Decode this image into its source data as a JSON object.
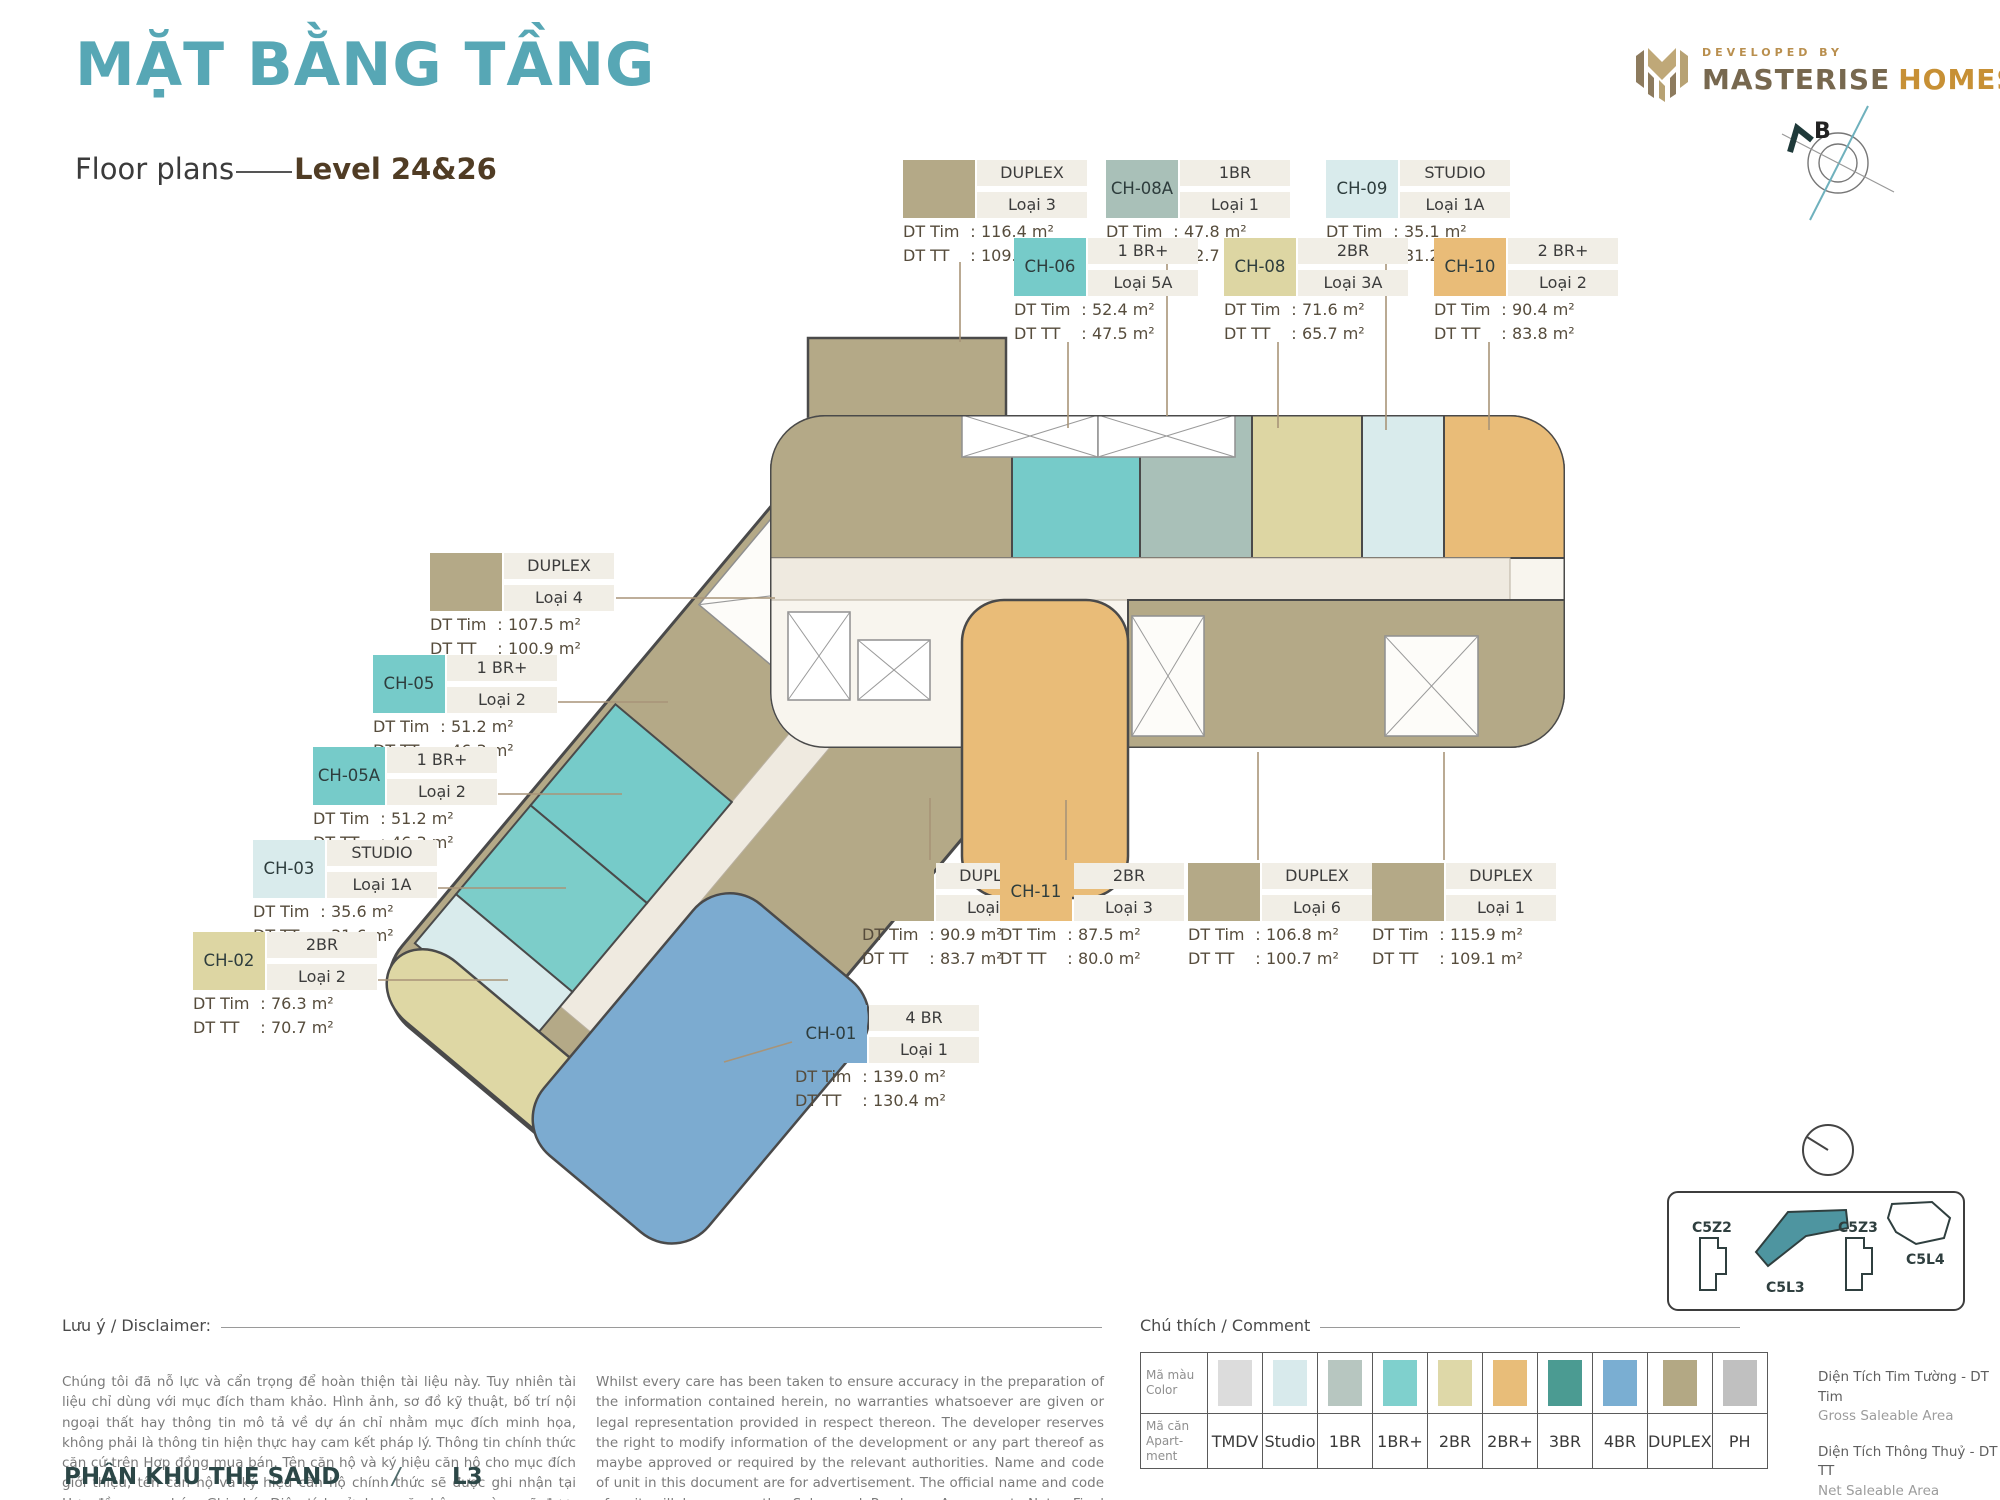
{
  "header": {
    "title": "MẶT BẰNG TẦNG",
    "subtitle": "Floor plans",
    "level": "Level 24&26",
    "developed_by": "DEVELOPED BY",
    "brand_1": "MASTERISE",
    "brand_2": "HOMES",
    "compass_north": "B"
  },
  "labels": {
    "dt_tim": "DT Tim",
    "dt_tt": "DT TT"
  },
  "units": [
    {
      "type": "DUPLEX",
      "loai": "Loại 3",
      "tim": "116.4 m²",
      "tt": "109.8 m²",
      "color": "#b4a987"
    },
    {
      "code": "CH-08A",
      "type": "1BR",
      "loai": "Loại 1",
      "tim": "47.8 m²",
      "tt": "42.7 m²",
      "color": "#a9c0b8"
    },
    {
      "code": "CH-09",
      "type": "STUDIO",
      "loai": "Loại 1A",
      "tim": "35.1 m²",
      "tt": "31.2 m²",
      "color": "#d9ebec"
    },
    {
      "code": "CH-06",
      "type": "1 BR+",
      "loai": "Loại 5A",
      "tim": "52.4 m²",
      "tt": "47.5 m²",
      "color": "#76cbc9"
    },
    {
      "code": "CH-08",
      "type": "2BR",
      "loai": "Loại 3A",
      "tim": "71.6 m²",
      "tt": "65.7 m²",
      "color": "#ddd6a3"
    },
    {
      "code": "CH-10",
      "type": "2 BR+",
      "loai": "Loại 2",
      "tim": "90.4 m²",
      "tt": "83.8 m²",
      "color": "#e9bc78"
    },
    {
      "type": "DUPLEX",
      "loai": "Loại 4",
      "tim": "107.5 m²",
      "tt": "100.9 m²",
      "color": "#b4a987"
    },
    {
      "code": "CH-05",
      "type": "1 BR+",
      "loai": "Loại 2",
      "tim": "51.2 m²",
      "tt": "46.3 m²",
      "color": "#76cbc9"
    },
    {
      "code": "CH-05A",
      "type": "1 BR+",
      "loai": "Loại 2",
      "tim": "51.2 m²",
      "tt": "46.3 m²",
      "color": "#76cbc9"
    },
    {
      "code": "CH-03",
      "type": "STUDIO",
      "loai": "Loại 1A",
      "tim": "35.6 m²",
      "tt": "31.6 m²",
      "color": "#d9ebec"
    },
    {
      "code": "CH-02",
      "type": "2BR",
      "loai": "Loại 2",
      "tim": "76.3 m²",
      "tt": "70.7 m²",
      "color": "#ddd6a3"
    },
    {
      "type": "DUPLEX",
      "loai": "Loại 5",
      "tim": "90.9 m²",
      "tt": "83.7 m²",
      "color": "#b4a987"
    },
    {
      "code": "CH-11",
      "type": "2BR",
      "loai": "Loại 3",
      "tim": "87.5 m²",
      "tt": "80.0 m²",
      "color": "#e9bc78"
    },
    {
      "type": "DUPLEX",
      "loai": "Loại 6",
      "tim": "106.8 m²",
      "tt": "100.7 m²",
      "color": "#b4a987"
    },
    {
      "type": "DUPLEX",
      "loai": "Loại 1",
      "tim": "115.9 m²",
      "tt": "109.1 m²",
      "color": "#b4a987"
    },
    {
      "code": "CH-01",
      "type": "4 BR",
      "loai": "Loại 1",
      "tim": "139.0 m²",
      "tt": "130.4 m²",
      "color": "#7cabd0"
    }
  ],
  "sections": {
    "disclaimer_label": "Lưu ý / Disclaimer:",
    "comment_label": "Chú thích / Comment",
    "disclaimer_vi": "Chúng tôi đã nỗ lực và cẩn trọng để hoàn thiện tài liệu này. Tuy nhiên tài liệu chỉ dùng với mục đích tham khảo. Hình ảnh, sơ đồ kỹ thuật, bố trí nội ngoại thất hay thông tin mô tả về dự án chỉ nhằm mục đích minh họa, không phải là thông tin hiện thực hay cam kết pháp lý. Thông tin chính thức căn cứ trên Hợp đồng mua bán. Tên căn hộ và ký hiệu căn hộ cho mục đích giới thiệu, tên căn hộ và ký hiệu căn hộ chính thức sẽ được ghi nhận tại Hợp đồng mua bán. Ghi chú: Diện tích sử dụng căn hộ sau cùng sẽ được xác minh bởi đơn vị đo đạc.",
    "disclaimer_en": "Whilst every care has been taken to ensure accuracy in the preparation of the information contained herein, no warranties whatsoever are given or legal representation provided in respect thereon. The developer reserves the right to modify information of the development or any part thereof as maybe approved or required by the relevant authorities. Name and code of unit in this document are for advertisement. The official name and code of unit will be as per the Sales and Purchase Agreement. Note: Final usable area to be verified by surveyor."
  },
  "legend": {
    "row1_header": [
      "Mã màu",
      "Color"
    ],
    "row2_header": [
      "Mã căn",
      "Apart-",
      "ment"
    ],
    "items": [
      {
        "label": "TMDV",
        "color": "#dcdcdc"
      },
      {
        "label": "Studio",
        "color": "#d8eaec"
      },
      {
        "label": "1BR",
        "color": "#b7c6c0"
      },
      {
        "label": "1BR+",
        "color": "#7fd0cd"
      },
      {
        "label": "2BR",
        "color": "#ded8a8"
      },
      {
        "label": "2BR+",
        "color": "#e8bd79"
      },
      {
        "label": "3BR",
        "color": "#4b9b92"
      },
      {
        "label": "4BR",
        "color": "#7aaed2"
      },
      {
        "label": "DUPLEX",
        "color": "#b3a884"
      },
      {
        "label": "PH",
        "color": "#c0c0c0"
      }
    ]
  },
  "notes": [
    {
      "vi": "Diện Tích Tim Tường - DT Tim",
      "en": "Gross Saleable Area"
    },
    {
      "vi": "Diện Tích Thông Thuỷ - DT TT",
      "en": "Net Saleable Area"
    }
  ],
  "keyplan": {
    "buildings": [
      "C5Z2",
      "C5L3",
      "C5Z3",
      "C5L4"
    ],
    "active": "C5L3",
    "active_color": "#4e95a0"
  },
  "footer": {
    "project": "PHÂN KHU THE SAND",
    "separator": "/",
    "level": "L3"
  }
}
